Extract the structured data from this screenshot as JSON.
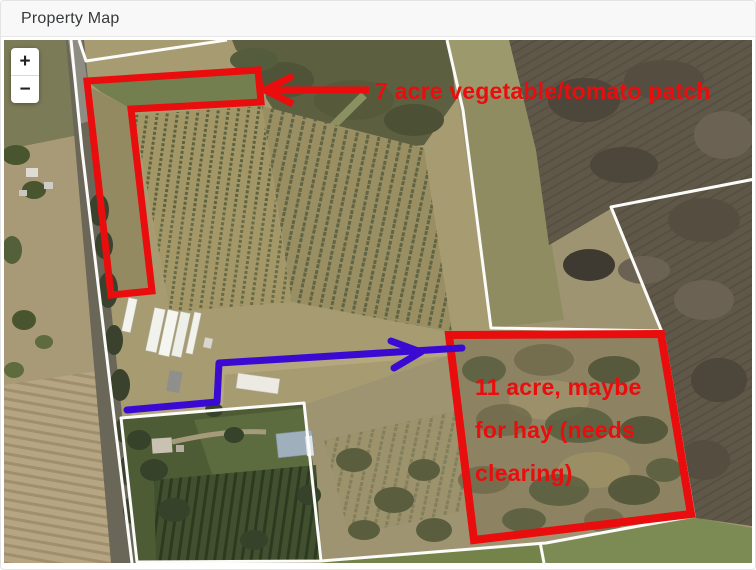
{
  "header": {
    "title": "Property Map"
  },
  "map": {
    "zoom_in_label": "+",
    "zoom_out_label": "−",
    "annotations": {
      "patch7": {
        "text": "7 acre vegetable/tomato patch"
      },
      "hay11": {
        "line1": "11 acre, maybe",
        "line2": "for hay (needs",
        "line3": "clearing)"
      }
    },
    "colors": {
      "annotation_red": "#e90d0d",
      "annotation_blue": "#3a0ad2",
      "boundary_white": "#fbfbf9"
    }
  }
}
